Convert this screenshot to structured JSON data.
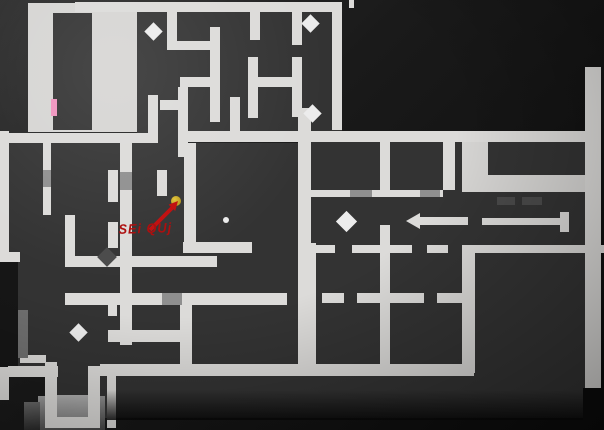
{
  "canvas": {
    "width": 604,
    "height": 430
  },
  "palette": {
    "floor": "#333333",
    "light": "#d6d5d3",
    "wall": "#dcdbd9",
    "graydoor": "#8f8f8f",
    "faint": "#6f6f6f",
    "darkdoor": "#4a4a4a",
    "pink": "#ef93be",
    "pickup": "#ececec",
    "gold": "radial-gradient(circle at 35% 35%, #e2c437, #a8870f)",
    "step": "linear-gradient(#b0b0b0,#8a8a8a)",
    "apron": "linear-gradient(175deg,#9e9e9e,#454545)",
    "apronside": "linear-gradient(175deg,#6a6a6a,#2a2a2a)",
    "bgpatch": "#161616",
    "fade": "linear-gradient(rgba(14,14,14,0),rgba(8,8,8,0.85))"
  },
  "map": {
    "rects": [
      {
        "name": "hall-floor-light",
        "k": "light",
        "r": [
          28,
          3,
          109,
          129
        ]
      },
      {
        "name": "maze-floor",
        "k": "floor",
        "r": [
          137,
          10,
          205,
          123
        ]
      },
      {
        "name": "hall-inner-room-floor",
        "k": "floor",
        "r": [
          53,
          13,
          39,
          117
        ]
      },
      {
        "name": "left-block-floor",
        "k": "floor",
        "r": [
          9,
          143,
          293,
          230
        ]
      },
      {
        "name": "mid-right-floor",
        "k": "floor",
        "r": [
          302,
          141,
          283,
          104
        ]
      },
      {
        "name": "grid-rooms-floor",
        "k": "floor",
        "r": [
          302,
          245,
          172,
          127
        ]
      },
      {
        "name": "right-lower-floor",
        "k": "floor",
        "r": [
          474,
          253,
          111,
          135
        ]
      },
      {
        "name": "bottom-strip-floor",
        "k": "floor",
        "r": [
          100,
          376,
          483,
          42
        ]
      },
      {
        "name": "entrance-corridor-floor",
        "k": "floor",
        "r": [
          57,
          362,
          31,
          35
        ]
      },
      {
        "name": "corridor-gap-floor",
        "k": "floor",
        "r": [
          455,
          140,
          7,
          65
        ]
      },
      {
        "name": "doorway-floor",
        "k": "floor",
        "r": [
          158,
          133,
          20,
          10
        ]
      },
      {
        "name": "doorway-floor",
        "k": "floor",
        "r": [
          20,
          134,
          18,
          9
        ]
      },
      {
        "name": "corridor-connector-light",
        "k": "light",
        "r": [
          462,
          131,
          26,
          61
        ]
      },
      {
        "name": "east-corridor-light",
        "k": "light",
        "r": [
          462,
          175,
          139,
          17
        ]
      },
      {
        "name": "bg-patch",
        "k": "bgpatch",
        "r": [
          0,
          252,
          18,
          115
        ]
      },
      {
        "name": "entrance-apron",
        "k": "apron",
        "r": [
          38,
          396,
          67,
          34
        ]
      },
      {
        "name": "entrance-apron-side",
        "k": "apronside",
        "r": [
          24,
          402,
          16,
          28
        ]
      },
      {
        "name": "entrance-step",
        "k": "step",
        "r": [
          57,
          395,
          31,
          23
        ]
      },
      {
        "name": "wall-top",
        "k": "wall",
        "r": [
          75,
          2,
          267,
          10
        ]
      },
      {
        "name": "wall-tick",
        "k": "wall",
        "r": [
          349,
          0,
          5,
          8
        ]
      },
      {
        "name": "wall-band-left",
        "k": "wall",
        "r": [
          0,
          133,
          158,
          10
        ]
      },
      {
        "name": "wall-band-right",
        "k": "wall",
        "r": [
          178,
          131,
          407,
          11
        ]
      },
      {
        "name": "wall-left-edge",
        "k": "wall",
        "r": [
          0,
          131,
          9,
          131
        ]
      },
      {
        "name": "wall",
        "k": "wall",
        "r": [
          0,
          252,
          20,
          10
        ]
      },
      {
        "name": "wall",
        "k": "wall",
        "r": [
          148,
          95,
          10,
          38
        ]
      },
      {
        "name": "wall",
        "k": "wall",
        "r": [
          167,
          12,
          10,
          33
        ]
      },
      {
        "name": "wall",
        "k": "wall",
        "r": [
          167,
          41,
          45,
          9
        ]
      },
      {
        "name": "wall",
        "k": "wall",
        "r": [
          210,
          27,
          10,
          95
        ]
      },
      {
        "name": "wall",
        "k": "wall",
        "r": [
          180,
          77,
          32,
          10
        ]
      },
      {
        "name": "wall",
        "k": "wall",
        "r": [
          178,
          87,
          10,
          70
        ]
      },
      {
        "name": "wall",
        "k": "wall",
        "r": [
          250,
          12,
          10,
          28
        ]
      },
      {
        "name": "wall",
        "k": "wall",
        "r": [
          248,
          57,
          10,
          61
        ]
      },
      {
        "name": "wall",
        "k": "wall",
        "r": [
          250,
          77,
          42,
          10
        ]
      },
      {
        "name": "wall",
        "k": "wall",
        "r": [
          292,
          8,
          10,
          37
        ]
      },
      {
        "name": "wall",
        "k": "wall",
        "r": [
          292,
          57,
          10,
          60
        ]
      },
      {
        "name": "wall",
        "k": "wall",
        "r": [
          160,
          100,
          20,
          10
        ]
      },
      {
        "name": "wall",
        "k": "wall",
        "r": [
          230,
          97,
          10,
          36
        ]
      },
      {
        "name": "wall-diamond-room",
        "k": "wall",
        "r": [
          332,
          3,
          10,
          127
        ]
      },
      {
        "name": "wall-long-vertical",
        "k": "wall",
        "r": [
          298,
          108,
          13,
          264
        ]
      },
      {
        "name": "wall",
        "k": "wall",
        "r": [
          43,
          143,
          8,
          72
        ]
      },
      {
        "name": "wall",
        "k": "wall",
        "r": [
          108,
          170,
          10,
          32
        ]
      },
      {
        "name": "wall",
        "k": "wall",
        "r": [
          108,
          222,
          10,
          26
        ]
      },
      {
        "name": "wall",
        "k": "wall",
        "r": [
          157,
          170,
          10,
          26
        ]
      },
      {
        "name": "wall",
        "k": "wall",
        "r": [
          184,
          143,
          12,
          110
        ]
      },
      {
        "name": "wall",
        "k": "wall",
        "r": [
          183,
          242,
          69,
          11
        ]
      },
      {
        "name": "wall",
        "k": "wall",
        "r": [
          65,
          256,
          152,
          11
        ]
      },
      {
        "name": "wall",
        "k": "wall",
        "r": [
          65,
          215,
          10,
          41
        ]
      },
      {
        "name": "wall",
        "k": "wall",
        "r": [
          120,
          143,
          12,
          202
        ]
      },
      {
        "name": "wall",
        "k": "wall",
        "r": [
          65,
          293,
          222,
          12
        ]
      },
      {
        "name": "wall",
        "k": "wall",
        "r": [
          108,
          305,
          9,
          11
        ]
      },
      {
        "name": "wall",
        "k": "wall",
        "r": [
          180,
          305,
          12,
          65
        ]
      },
      {
        "name": "wall",
        "k": "wall",
        "r": [
          108,
          330,
          77,
          12
        ]
      },
      {
        "name": "wall",
        "k": "wall",
        "r": [
          380,
          141,
          10,
          49
        ]
      },
      {
        "name": "wall",
        "k": "wall",
        "r": [
          380,
          225,
          10,
          147
        ]
      },
      {
        "name": "wall",
        "k": "wall",
        "r": [
          300,
          190,
          143,
          7
        ]
      },
      {
        "name": "wall",
        "k": "wall",
        "r": [
          443,
          131,
          12,
          59
        ]
      },
      {
        "name": "wall",
        "k": "wall",
        "r": [
          303,
          243,
          13,
          129
        ]
      },
      {
        "name": "wall",
        "k": "wall",
        "r": [
          462,
          245,
          13,
          128
        ]
      },
      {
        "name": "wall",
        "k": "wall",
        "r": [
          322,
          293,
          22,
          10
        ]
      },
      {
        "name": "wall",
        "k": "wall",
        "r": [
          357,
          293,
          67,
          10
        ]
      },
      {
        "name": "wall",
        "k": "wall",
        "r": [
          437,
          293,
          25,
          10
        ]
      },
      {
        "name": "wall-bottom",
        "k": "wall",
        "r": [
          100,
          364,
          374,
          12
        ]
      },
      {
        "name": "wall-bottom",
        "k": "wall",
        "r": [
          8,
          366,
          50,
          11
        ]
      },
      {
        "name": "wall-bottom",
        "k": "wall",
        "r": [
          88,
          366,
          12,
          11
        ]
      },
      {
        "name": "wall",
        "k": "wall",
        "r": [
          107,
          370,
          9,
          58
        ]
      },
      {
        "name": "wall-south-row",
        "k": "wall",
        "r": [
          302,
          245,
          33,
          8
        ]
      },
      {
        "name": "wall-south-row",
        "k": "wall",
        "r": [
          352,
          245,
          60,
          8
        ]
      },
      {
        "name": "wall-south-row",
        "k": "wall",
        "r": [
          427,
          245,
          21,
          8
        ]
      },
      {
        "name": "wall-south-row",
        "k": "wall",
        "r": [
          475,
          245,
          129,
          8
        ]
      },
      {
        "name": "wall-right-edge",
        "k": "wall",
        "r": [
          585,
          67,
          16,
          321
        ]
      },
      {
        "name": "entrance-wall-left",
        "k": "wall",
        "r": [
          45,
          362,
          12,
          66
        ]
      },
      {
        "name": "entrance-wall-right",
        "k": "wall",
        "r": [
          88,
          368,
          12,
          52
        ]
      },
      {
        "name": "entrance-wall-cap",
        "k": "wall",
        "r": [
          45,
          417,
          55,
          11
        ]
      },
      {
        "name": "wall",
        "k": "wall",
        "r": [
          20,
          355,
          26,
          8
        ]
      },
      {
        "name": "wall",
        "k": "wall",
        "r": [
          0,
          367,
          9,
          33
        ]
      },
      {
        "name": "door-notch",
        "k": "graydoor",
        "r": [
          43,
          170,
          8,
          17
        ]
      },
      {
        "name": "door-notch",
        "k": "graydoor",
        "r": [
          120,
          172,
          12,
          18
        ]
      },
      {
        "name": "door-notch",
        "k": "graydoor",
        "r": [
          162,
          293,
          20,
          12
        ]
      },
      {
        "name": "door-notch",
        "k": "graydoor",
        "r": [
          350,
          190,
          22,
          7
        ]
      },
      {
        "name": "door-notch",
        "k": "graydoor",
        "r": [
          420,
          190,
          20,
          7
        ]
      },
      {
        "name": "door-mark",
        "k": "darkdoor",
        "r": [
          497,
          197,
          18,
          8
        ]
      },
      {
        "name": "door-mark",
        "k": "darkdoor",
        "r": [
          522,
          197,
          20,
          8
        ]
      },
      {
        "name": "pink-door",
        "k": "pink",
        "r": [
          51,
          99,
          6,
          17
        ]
      },
      {
        "name": "gray-wall-faint",
        "k": "faint",
        "r": [
          18,
          310,
          10,
          48
        ]
      },
      {
        "name": "table-arrow-bar",
        "k": "wall",
        "r": [
          418,
          217,
          50,
          8
        ]
      },
      {
        "name": "table-arrow-tip",
        "k": "wall",
        "r": [
          406,
          213,
          14,
          16
        ],
        "clip": "polygon(0 50%, 100% 0, 100% 100%)"
      },
      {
        "name": "table-bar",
        "k": "wall",
        "r": [
          482,
          218,
          80,
          7
        ]
      },
      {
        "name": "table-bar-cap",
        "k": "wall",
        "r": [
          560,
          212,
          9,
          20
        ]
      },
      {
        "name": "bottom-fade",
        "k": "fade",
        "r": [
          107,
          390,
          476,
          30
        ]
      }
    ],
    "diamonds": [
      {
        "name": "pickup-diamond",
        "k": "pickup",
        "cx": 153,
        "cy": 31,
        "s": 13
      },
      {
        "name": "pickup-diamond",
        "k": "pickup",
        "cx": 310,
        "cy": 23,
        "s": 13
      },
      {
        "name": "pickup-diamond",
        "k": "pickup",
        "cx": 312,
        "cy": 113,
        "s": 13
      },
      {
        "name": "pickup-diamond",
        "k": "pickup",
        "cx": 346,
        "cy": 221,
        "s": 15
      },
      {
        "name": "pickup-diamond",
        "k": "pickup",
        "cx": 78,
        "cy": 332,
        "s": 13
      },
      {
        "name": "door-diamond",
        "k": "darkdoor",
        "cx": 107,
        "cy": 257,
        "s": 14
      }
    ],
    "dots": [
      {
        "name": "player-marker-dot",
        "k": "gold",
        "cx": 176,
        "cy": 201,
        "r": 5
      },
      {
        "name": "small-pickup-dot",
        "k": "pickup",
        "cx": 226,
        "cy": 220,
        "r": 3
      }
    ]
  },
  "annotation": {
    "text": "SEi QUj",
    "x": 117,
    "y": 221,
    "color": "#ad0f0f",
    "arrow": {
      "x1": 150,
      "y1": 230,
      "x2": 173,
      "y2": 207,
      "head": "178,201 175.2,211 168.6,204.6",
      "color": "#c11212",
      "width": 4
    }
  }
}
